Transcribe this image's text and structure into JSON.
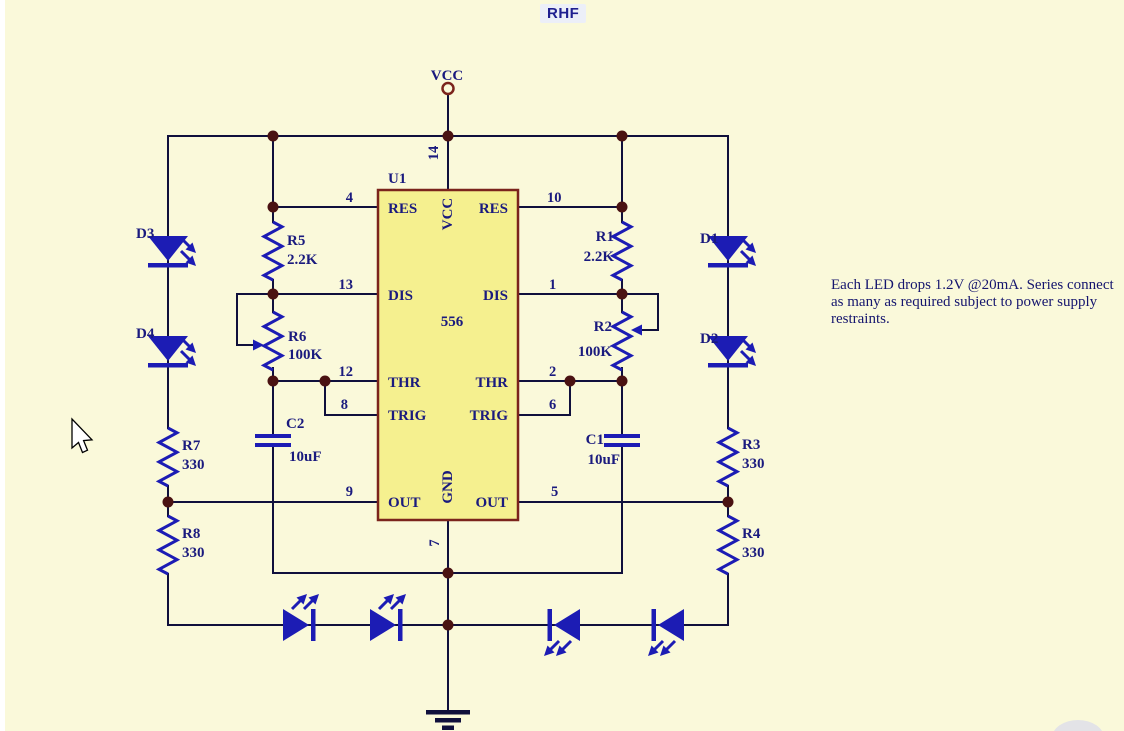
{
  "title": "RHF",
  "note": {
    "line1": "Each LED drops 1.2V @20mA.  Series connect",
    "line2": "as many as required subject to power supply",
    "line3": "restraints."
  },
  "power": {
    "vcc": "VCC"
  },
  "ic": {
    "ref": "U1",
    "part": "556",
    "pins": {
      "left": [
        {
          "num": "4",
          "name": "RES"
        },
        {
          "num": "13",
          "name": "DIS"
        },
        {
          "num": "12",
          "name": "THR"
        },
        {
          "num": "8",
          "name": "TRIG"
        },
        {
          "num": "9",
          "name": "OUT"
        }
      ],
      "right": [
        {
          "num": "10",
          "name": "RES"
        },
        {
          "num": "1",
          "name": "DIS"
        },
        {
          "num": "2",
          "name": "THR"
        },
        {
          "num": "6",
          "name": "TRIG"
        },
        {
          "num": "5",
          "name": "OUT"
        }
      ],
      "top": {
        "num": "14",
        "name": "VCC"
      },
      "bottom": {
        "num": "7",
        "name": "GND"
      }
    }
  },
  "components": {
    "r1": {
      "ref": "R1",
      "value": "2.2K"
    },
    "r2": {
      "ref": "R2",
      "value": "100K"
    },
    "r3": {
      "ref": "R3",
      "value": "330"
    },
    "r4": {
      "ref": "R4",
      "value": "330"
    },
    "r5": {
      "ref": "R5",
      "value": "2.2K"
    },
    "r6": {
      "ref": "R6",
      "value": "100K"
    },
    "r7": {
      "ref": "R7",
      "value": "330"
    },
    "r8": {
      "ref": "R8",
      "value": "330"
    },
    "c1": {
      "ref": "C1",
      "value": "10uF"
    },
    "c2": {
      "ref": "C2",
      "value": "10uF"
    },
    "d1": {
      "ref": "D1"
    },
    "d2": {
      "ref": "D2"
    },
    "d3": {
      "ref": "D3"
    },
    "d4": {
      "ref": "D4"
    }
  },
  "colors": {
    "background": "#FAF9DA",
    "wire": "#10103C",
    "component_blue": "#1C1CB4",
    "label_navy": "#1A1A7E",
    "ic_fill": "#F5F08F",
    "ic_border": "#7B241C",
    "junction_dot": "#4A1212"
  }
}
